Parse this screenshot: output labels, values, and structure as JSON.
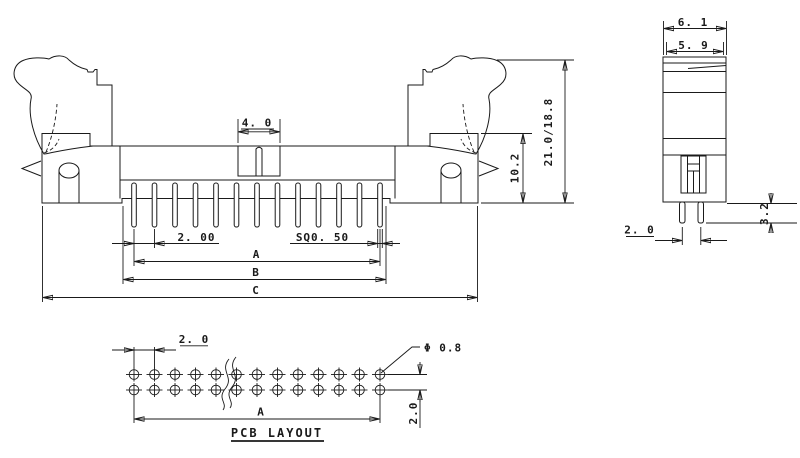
{
  "front_view": {
    "dim_key": "4. 0",
    "dim_total_height": "21.0/18.8",
    "dim_body_height": "10.2",
    "dim_pitch": "2. 00",
    "dim_pin": "SQ0. 50",
    "dim_a": "A",
    "dim_b": "B",
    "dim_c": "C",
    "pin_count": 13
  },
  "side_view": {
    "dim_outer_width": "6. 1",
    "dim_inner_width": "5. 9",
    "dim_pin_spacing": "2. 0",
    "dim_pin_length": "3.2"
  },
  "pcb_layout": {
    "title": "PCB LAYOUT",
    "dim_pitch": "2. 0",
    "dim_hole_dia": "Φ 0.8",
    "dim_row_spacing": "2.0",
    "dim_a": "A",
    "pad_columns": 13,
    "pad_rows": 2,
    "pad_row_y": [
      374.5,
      390
    ],
    "pad_start_x": 134,
    "pad_pitch_px": 20.5
  },
  "colors": {
    "line": "#1a1a1a",
    "background": "#ffffff"
  }
}
